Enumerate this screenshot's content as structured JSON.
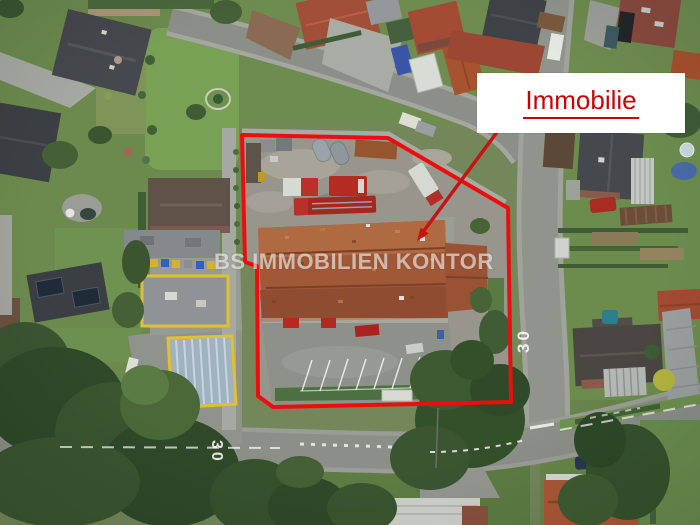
{
  "label_box": {
    "text": "Immobilie",
    "text_color": "#cf0004",
    "background": "#ffffff"
  },
  "watermark": {
    "text": "BS IMMOBILIEN KONTOR",
    "color": "rgba(255,255,255,0.58)"
  },
  "boundary": {
    "color": "#ec0e0e"
  },
  "pointer": {
    "color": "#c51511"
  },
  "road_markings": {
    "vertical_road_speed": "30",
    "bottom_road_speed": "30"
  }
}
